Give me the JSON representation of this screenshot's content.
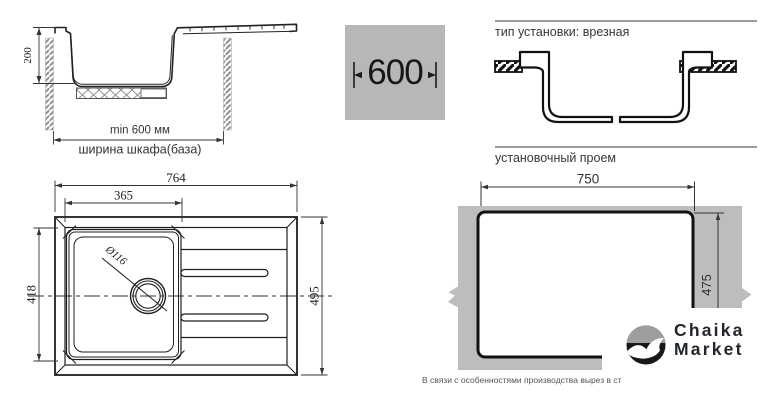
{
  "side_view": {
    "height": "200",
    "min_width": "min 600 мм",
    "cabinet": "ширина шкафа(база)"
  },
  "badge_600": "600",
  "sections": {
    "install_type": "тип установки: врезная",
    "cutout": "установочный проем"
  },
  "top_view": {
    "overall_width": "764",
    "bowl_width": "365",
    "bowl_depth": "418",
    "overall_depth": "495",
    "drain": "Ø116"
  },
  "cutout": {
    "width": "750",
    "depth": "475"
  },
  "logo": {
    "line1": "Chaika",
    "line2": "Market"
  },
  "footnote": "В связи с особенностями производства вырез в ст",
  "colors": {
    "countertop_gray": "#bdbdbd",
    "badge_gray": "#b7b7b7",
    "logo_gray": "#9e9e9e",
    "ink": "#1a1a1a"
  }
}
